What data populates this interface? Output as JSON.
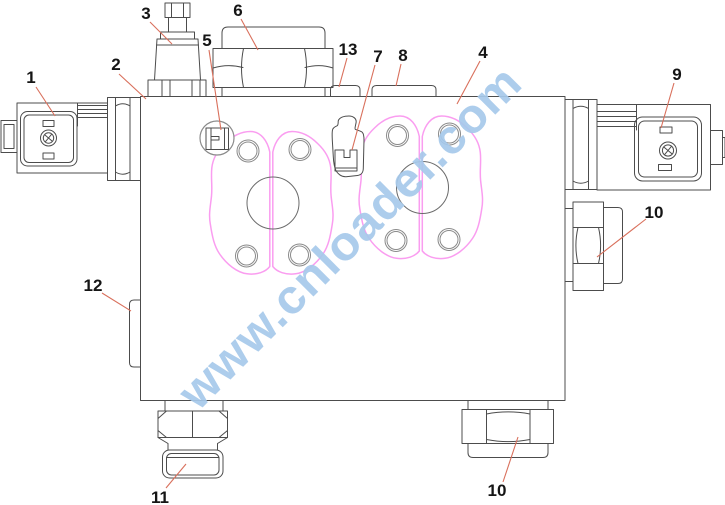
{
  "diagram": {
    "type": "hydraulic-valve-block-exploded-callout-drawing",
    "watermark": {
      "text": "www.cnloader.com",
      "color": "#a6c9ea"
    },
    "colors": {
      "outline": "#4c4c4c",
      "secondary": "#8a8a8a",
      "circle": "#6b6b6b",
      "flange": "#fa9df0",
      "leader": "#d9705c",
      "label": "#151515",
      "background": "#ffffff"
    },
    "part_numbers": [
      "1",
      "2",
      "3",
      "4",
      "5",
      "6",
      "7",
      "8",
      "9",
      "10",
      "11",
      "12",
      "13"
    ],
    "callouts": [
      {
        "label": "1",
        "tx": 31,
        "ty": 77,
        "x1": 36,
        "y1": 87,
        "x2": 55,
        "y2": 116
      },
      {
        "label": "2",
        "tx": 116,
        "ty": 64,
        "x1": 119,
        "y1": 74,
        "x2": 146,
        "y2": 99
      },
      {
        "label": "3",
        "tx": 146,
        "ty": 13,
        "x1": 150,
        "y1": 22,
        "x2": 172,
        "y2": 44
      },
      {
        "label": "5",
        "tx": 207,
        "ty": 40,
        "x1": 209,
        "y1": 50,
        "x2": 221,
        "y2": 130
      },
      {
        "label": "6",
        "tx": 238,
        "ty": 10,
        "x1": 241,
        "y1": 19,
        "x2": 258,
        "y2": 50
      },
      {
        "label": "13",
        "tx": 348,
        "ty": 49,
        "x1": 347,
        "y1": 58,
        "x2": 339,
        "y2": 87
      },
      {
        "label": "7",
        "tx": 378,
        "ty": 56,
        "x1": 375,
        "y1": 65,
        "x2": 352,
        "y2": 150
      },
      {
        "label": "8",
        "tx": 403,
        "ty": 55,
        "x1": 401,
        "y1": 64,
        "x2": 396,
        "y2": 86
      },
      {
        "label": "4",
        "tx": 483,
        "ty": 52,
        "x1": 480,
        "y1": 61,
        "x2": 457,
        "y2": 104
      },
      {
        "label": "9",
        "tx": 677,
        "ty": 74,
        "x1": 674,
        "y1": 83,
        "x2": 661,
        "y2": 128
      },
      {
        "label": "10",
        "tx": 654,
        "ty": 212,
        "x1": 646,
        "y1": 219,
        "x2": 597,
        "y2": 257
      },
      {
        "label": "12",
        "tx": 93,
        "ty": 285,
        "x1": 102,
        "y1": 293,
        "x2": 131,
        "y2": 311
      },
      {
        "label": "11",
        "tx": 160,
        "ty": 497,
        "x1": 166,
        "y1": 488,
        "x2": 186,
        "y2": 464
      },
      {
        "label": "10",
        "tx": 497,
        "ty": 490,
        "x1": 503,
        "y1": 482,
        "x2": 518,
        "y2": 437
      }
    ]
  }
}
